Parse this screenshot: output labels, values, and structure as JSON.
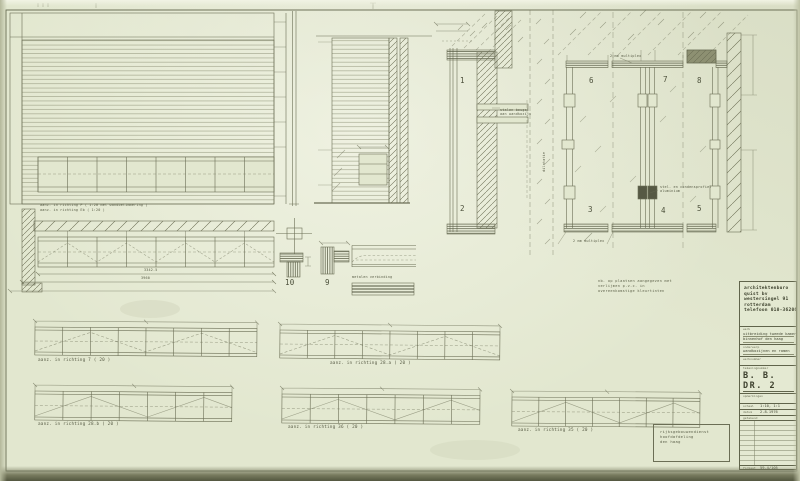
{
  "captions": {
    "elev_main_1": "aanz. in richting P  ( 1:20 met wandbetimmering )",
    "elev_main_2": "aanz. in richting Eb ( 1:20 )",
    "strip_7": "aanz. in richting 7  ( 20 )",
    "strip_28a": "aanz. in richting 28.a  ( 20 )",
    "strip_28b": "aanz. in richting 28.b  ( 20 )",
    "strip_36": "aanz. in richting 36  ( 20 )",
    "strip_35": "aanz. in richting 35  ( 20 )"
  },
  "details": {
    "d1": "1",
    "d2": "2",
    "d3": "3",
    "d4": "4",
    "d5": "5",
    "d6": "6",
    "d7": "7",
    "d8": "8",
    "d9": "9",
    "d10": "10"
  },
  "annotations": {
    "multiplex_top": "2 mm multiplex",
    "multiplex_bottom": "2 mm multiplex",
    "profiel1": "stel- en condensprofiel",
    "profiel2": "aluminium",
    "beugel1": "stalen beugel",
    "beugel2": "aan wandkozijn",
    "metalen": "metalen verbinding",
    "dilatatie": "dilatatie",
    "dim_a": "3342.5",
    "dim_b": "3960"
  },
  "note": {
    "line1": "nb. op plaatsen aangegeven met",
    "line2": "verlijmen  p.v.c. in",
    "line3": "overeenkomstige kleurtinten"
  },
  "stamp": {
    "line1": "rijksgebouwendienst",
    "line2": "hoofdafdeling",
    "line3": "den haag"
  },
  "titleblock": {
    "firm": [
      "architektenburo",
      "quist bv",
      "westersingel 91",
      "rotterdam",
      "telefoon 010-362066"
    ],
    "werk_label": "werk",
    "werk_value1": "uitbreiding tweede kamer",
    "werk_value2": "binnenhof  den haag",
    "onderwerp_label": "onderwerp",
    "onderwerp_value": "wandkozijnen en ramen",
    "werknummer_label": "werknummer",
    "teknr_label": "tekeningnummer",
    "drawing_number": "B. B. DR. 2",
    "opmerkingen_label": "opmerkingen",
    "schaal_label": "schaal",
    "schaal_value": "1:10, 1:1",
    "datum_label": "datum",
    "datum_value": "2.8.1976",
    "getekend_label": "getekend",
    "formaat_label": "formaat",
    "formaat_value": "59,4/105"
  }
}
